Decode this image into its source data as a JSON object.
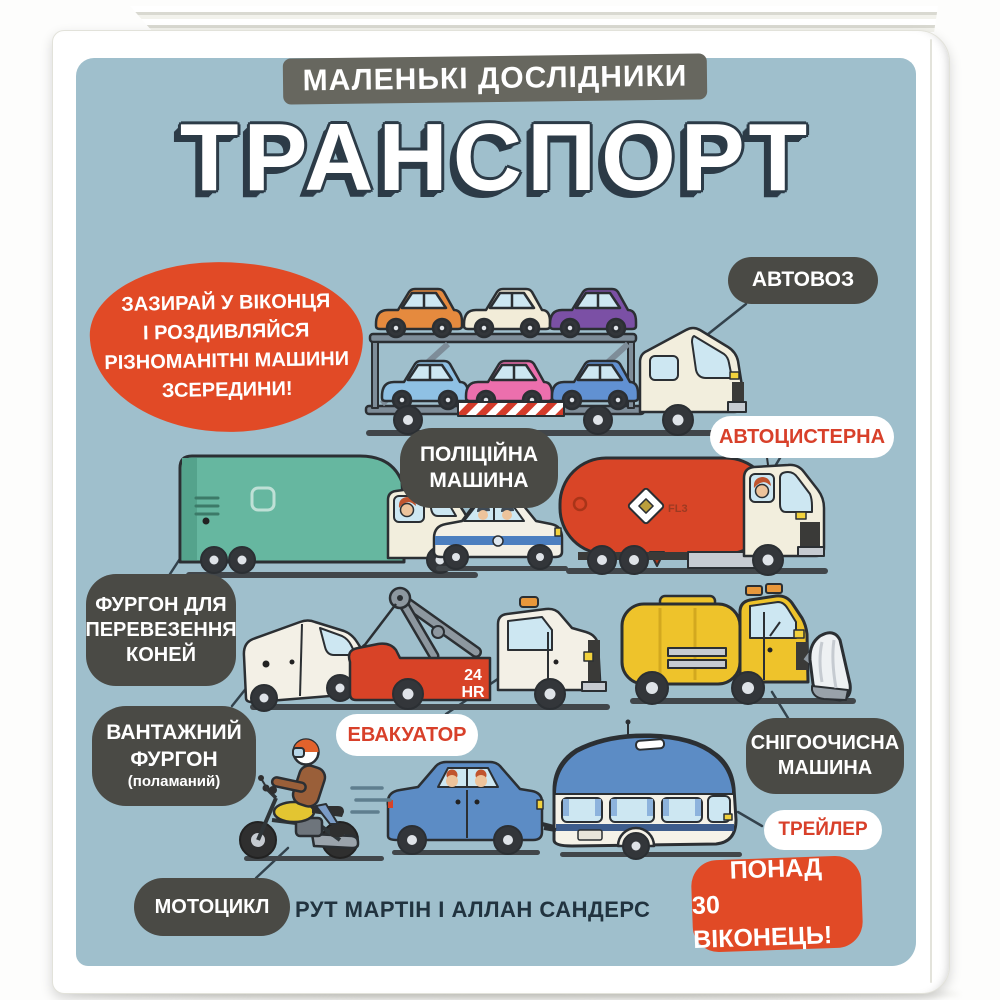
{
  "cover": {
    "series": "МАЛЕНЬКІ ДОСЛІДНИКИ",
    "title": "ТРАНСПОРТ",
    "authors": "РУТ МАРТІН І АЛЛАН САНДЕРС"
  },
  "tagline": {
    "line1": "ЗАЗИРАЙ У ВІКОНЦЯ",
    "line2": "І РОЗДИВЛЯЙСЯ",
    "line3": "РІЗНОМАНІТНІ МАШИНИ",
    "line4": "ЗСЕРЕДИНИ!"
  },
  "labels": {
    "car_transporter": {
      "text": "АВТОВОЗ"
    },
    "police_car": {
      "line1": "ПОЛІЦІЙНА",
      "line2": "МАШИНА"
    },
    "tanker": {
      "text": "АВТОЦИСТЕРНА"
    },
    "horse_van": {
      "line1": "ФУРГОН ДЛЯ",
      "line2": "ПЕРЕВЕЗЕННЯ",
      "line3": "КОНЕЙ"
    },
    "cargo_van": {
      "line1": "ВАНТАЖНИЙ",
      "line2": "ФУРГОН",
      "note": "(поламаний)"
    },
    "tow_truck": {
      "text": "ЕВАКУАТОР"
    },
    "snow_plow": {
      "line1": "СНІГООЧИСНА",
      "line2": "МАШИНА"
    },
    "trailer": {
      "text": "ТРЕЙЛЕР"
    },
    "motorcycle": {
      "text": "МОТОЦИКЛ"
    }
  },
  "badge": {
    "line1": "ПОНАД",
    "line2": "30 ВІКОНЕЦЬ!"
  },
  "illustration_text": {
    "tow_sign_line1": "24",
    "tow_sign_line2": "HR",
    "tanker_placard": "FL3"
  },
  "colors": {
    "panel_blue": "#9fbfcc",
    "label_dark": "#4a4a45",
    "accent_red": "#e14a26",
    "label_text_red": "#d8402a",
    "banner_gray": "#67675f",
    "title_outline_navy": "#2c3b47"
  }
}
